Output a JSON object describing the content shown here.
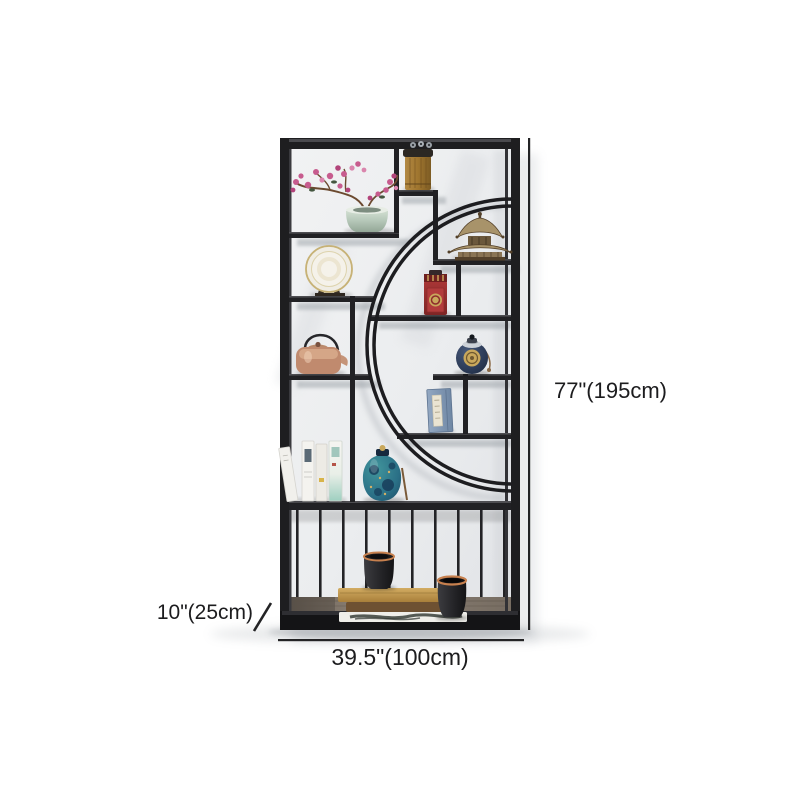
{
  "scene": {
    "description_label": "display-shelf-product-render",
    "items": [
      "plum-blossom-vase",
      "gold-canister",
      "pagoda-figurine",
      "decorative-plate",
      "red-tea-caddy",
      "copper-teapot",
      "navy-jar",
      "blue-book-box",
      "white-books",
      "teal-jar",
      "black-canister",
      "book-stack",
      "magazine",
      "black-vase",
      "wood-plank",
      "slat-rail"
    ]
  },
  "dimensions": {
    "height": "77\"(195cm)",
    "depth": "10\"(25cm)",
    "width": "39.5\"(100cm)",
    "height_in": 77,
    "height_cm": 195,
    "depth_in": 10,
    "depth_cm": 25,
    "width_in": 39.5,
    "width_cm": 100
  },
  "colors": {
    "bg": "#ffffff",
    "text": "#1c1c1e",
    "frame": "#1e1e20",
    "wall": "#edeef0",
    "celadon": "#b7c9ba",
    "blossom": "#c75c8e",
    "gold": "#c9a85c",
    "caddy-red": "#9c3232",
    "copper": "#c08a6e",
    "navy": "#2c3e5a",
    "teal": "#2f7f88",
    "wood": "#85796c",
    "book-tan": "#c9a35c"
  }
}
